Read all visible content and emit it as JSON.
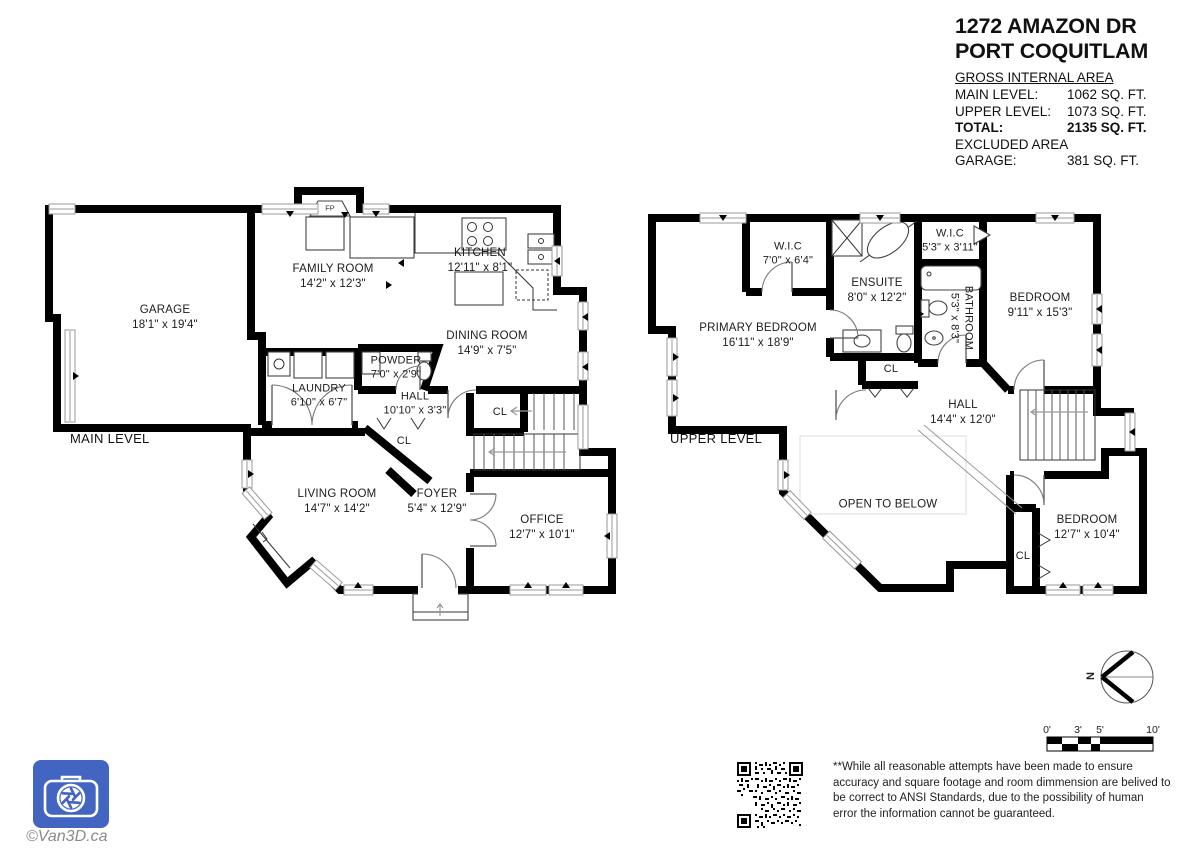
{
  "header": {
    "title_line1": "1272 AMAZON DR",
    "title_line2": "PORT COQUITLAM",
    "area_heading": "GROSS INTERNAL AREA",
    "rows": [
      {
        "label": "MAIN LEVEL:",
        "value": "1062 SQ. FT."
      },
      {
        "label": "UPPER LEVEL:",
        "value": "1073 SQ. FT."
      },
      {
        "label": "TOTAL:",
        "value": "2135 SQ. FT."
      },
      {
        "label": "GARAGE:",
        "value": "381 SQ. FT."
      }
    ],
    "excluded_heading": "EXCLUDED AREA"
  },
  "main_level": {
    "level_label": "MAIN LEVEL",
    "fp_label": "FP",
    "rooms": {
      "garage": {
        "name": "GARAGE",
        "dims": "18'1\" x 19'4\""
      },
      "family_room": {
        "name": "FAMILY ROOM",
        "dims": "14'2\" x 12'3\""
      },
      "kitchen": {
        "name": "KITCHEN",
        "dims": "12'11\" x 8'1\""
      },
      "dining_room": {
        "name": "DINING ROOM",
        "dims": "14'9\" x 7'5\""
      },
      "powder": {
        "name": "POWDER",
        "dims": "7'0\" x 2'9\""
      },
      "laundry": {
        "name": "LAUNDRY",
        "dims": "6'10\" x 6'7\""
      },
      "hall": {
        "name": "HALL",
        "dims": "10'10\" x 3'3\""
      },
      "living_room": {
        "name": "LIVING ROOM",
        "dims": "14'7\" x 14'2\""
      },
      "foyer": {
        "name": "FOYER",
        "dims": "5'4\" x 12'9\""
      },
      "office": {
        "name": "OFFICE",
        "dims": "12'7\" x 10'1\""
      }
    },
    "closets": {
      "stairs_cl": "CL",
      "hall_cl": "CL"
    }
  },
  "upper_level": {
    "level_label": "UPPER LEVEL",
    "open_to_below_label": "OPEN TO BELOW",
    "rooms": {
      "primary_bedroom": {
        "name": "PRIMARY BEDROOM",
        "dims": "16'11\" x 18'9\""
      },
      "wic_primary": {
        "name": "W.I.C",
        "dims": "7'0\" x 6'4\""
      },
      "ensuite": {
        "name": "ENSUITE",
        "dims": "8'0\" x 12'2\""
      },
      "wic_small": {
        "name": "W.I.C",
        "dims": "5'3\" x 3'11\""
      },
      "bathroom": {
        "name": "BATHROOM",
        "dims": "5'3\" x 8'3\""
      },
      "bedroom_top": {
        "name": "BEDROOM",
        "dims": "9'11\" x 15'3\""
      },
      "hall": {
        "name": "HALL",
        "dims": "14'4\" x 12'0\""
      },
      "bedroom_bottom": {
        "name": "BEDROOM",
        "dims": "12'7\" x 10'4\""
      }
    },
    "closets": {
      "ensuite_cl": "CL",
      "bedroom_cl": "CL"
    }
  },
  "footer": {
    "disclaimer": "**While all reasonable attempts have been made to ensure accuracy and square footage and room dimmension are belived to be correct to ANSI Standards, due to the possibility of human error the information cannot be guaranteed.",
    "credit": "©Van3D.ca",
    "compass_n": "N",
    "scale_labels": [
      "0'",
      "3'",
      "5'",
      "10'"
    ]
  },
  "colors": {
    "logo_blue": "#4365c2",
    "wall_black": "#000000"
  }
}
